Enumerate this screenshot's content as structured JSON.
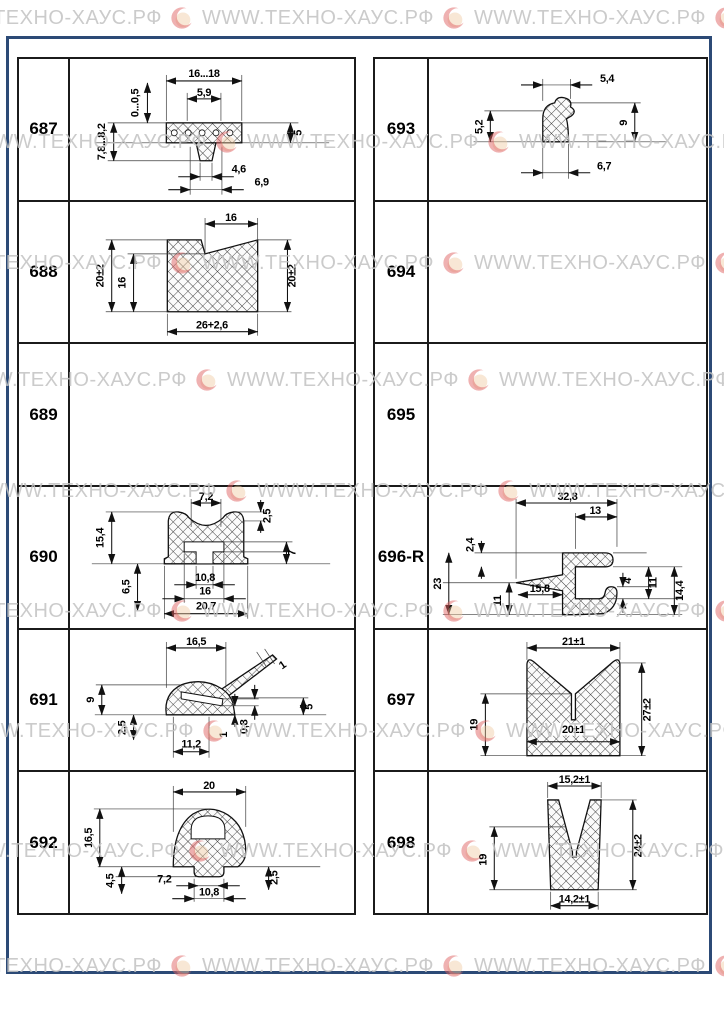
{
  "watermark": {
    "text": "WWW.ТЕХНО-ХАУС.РФ",
    "repeats": 4,
    "rows": [
      {
        "y": 6,
        "x": -70
      },
      {
        "y": 130,
        "x": -25
      },
      {
        "y": 251,
        "x": -70
      },
      {
        "y": 368,
        "x": -45
      },
      {
        "y": 479,
        "x": -15
      },
      {
        "y": 599,
        "x": -70
      },
      {
        "y": 719,
        "x": -38
      },
      {
        "y": 839,
        "x": -52
      },
      {
        "y": 954,
        "x": -70
      }
    ]
  },
  "colors": {
    "frame_blue": "#2c4a76",
    "line_black": "#1b1b1b",
    "watermark_gray": "#c3c3c3",
    "logo_red": "#de6060"
  },
  "parts": [
    {
      "id": "687",
      "dims": {
        "top_outer": "16...18",
        "top_inner": "5,9",
        "left_small": "0...0,5",
        "left_main": "7,8...8,2",
        "right": "5",
        "bottom_inner": "4,6",
        "bottom_outer": "6,9"
      }
    },
    {
      "id": "688",
      "dims": {
        "top": "16",
        "left": "20±2",
        "left_inner": "16",
        "right": "20±2",
        "bottom": "26+2,6"
      }
    },
    {
      "id": "689",
      "dims": {}
    },
    {
      "id": "690",
      "dims": {
        "top": "7,2",
        "top_right": "2,5",
        "left": "15,4",
        "left_lower": "6,5",
        "right": "7",
        "slot": "10,8",
        "mid": "16",
        "bottom": "20,7"
      }
    },
    {
      "id": "691",
      "dims": {
        "top": "16,5",
        "left": "9",
        "left_lower": "2,5",
        "bottom": "11,2",
        "flap": "1",
        "right": "5",
        "wall": "0,8",
        "wall2": "1"
      }
    },
    {
      "id": "692",
      "dims": {
        "top": "20",
        "left": "16,5",
        "left_lower": "4,5",
        "neck": "7,2",
        "stem": "10,8",
        "right": "2,5"
      }
    },
    {
      "id": "693",
      "dims": {
        "top": "5,4",
        "left": "5,2",
        "right": "9",
        "bottom": "6,7"
      }
    },
    {
      "id": "694",
      "dims": {}
    },
    {
      "id": "695",
      "dims": {}
    },
    {
      "id": "696-R",
      "dims": {
        "top": "32,8",
        "arm": "13",
        "gap": "2,4",
        "left": "23",
        "left_lower": "11",
        "fin": "15,8",
        "hook": "4",
        "right": "11",
        "right_outer": "14,4"
      }
    },
    {
      "id": "697",
      "dims": {
        "top": "21±1",
        "left": "19",
        "inner": "20±1",
        "right": "27±2"
      }
    },
    {
      "id": "698",
      "dims": {
        "top": "15,2±1",
        "left": "19",
        "right": "24±2",
        "bottom": "14,2±1"
      }
    }
  ]
}
